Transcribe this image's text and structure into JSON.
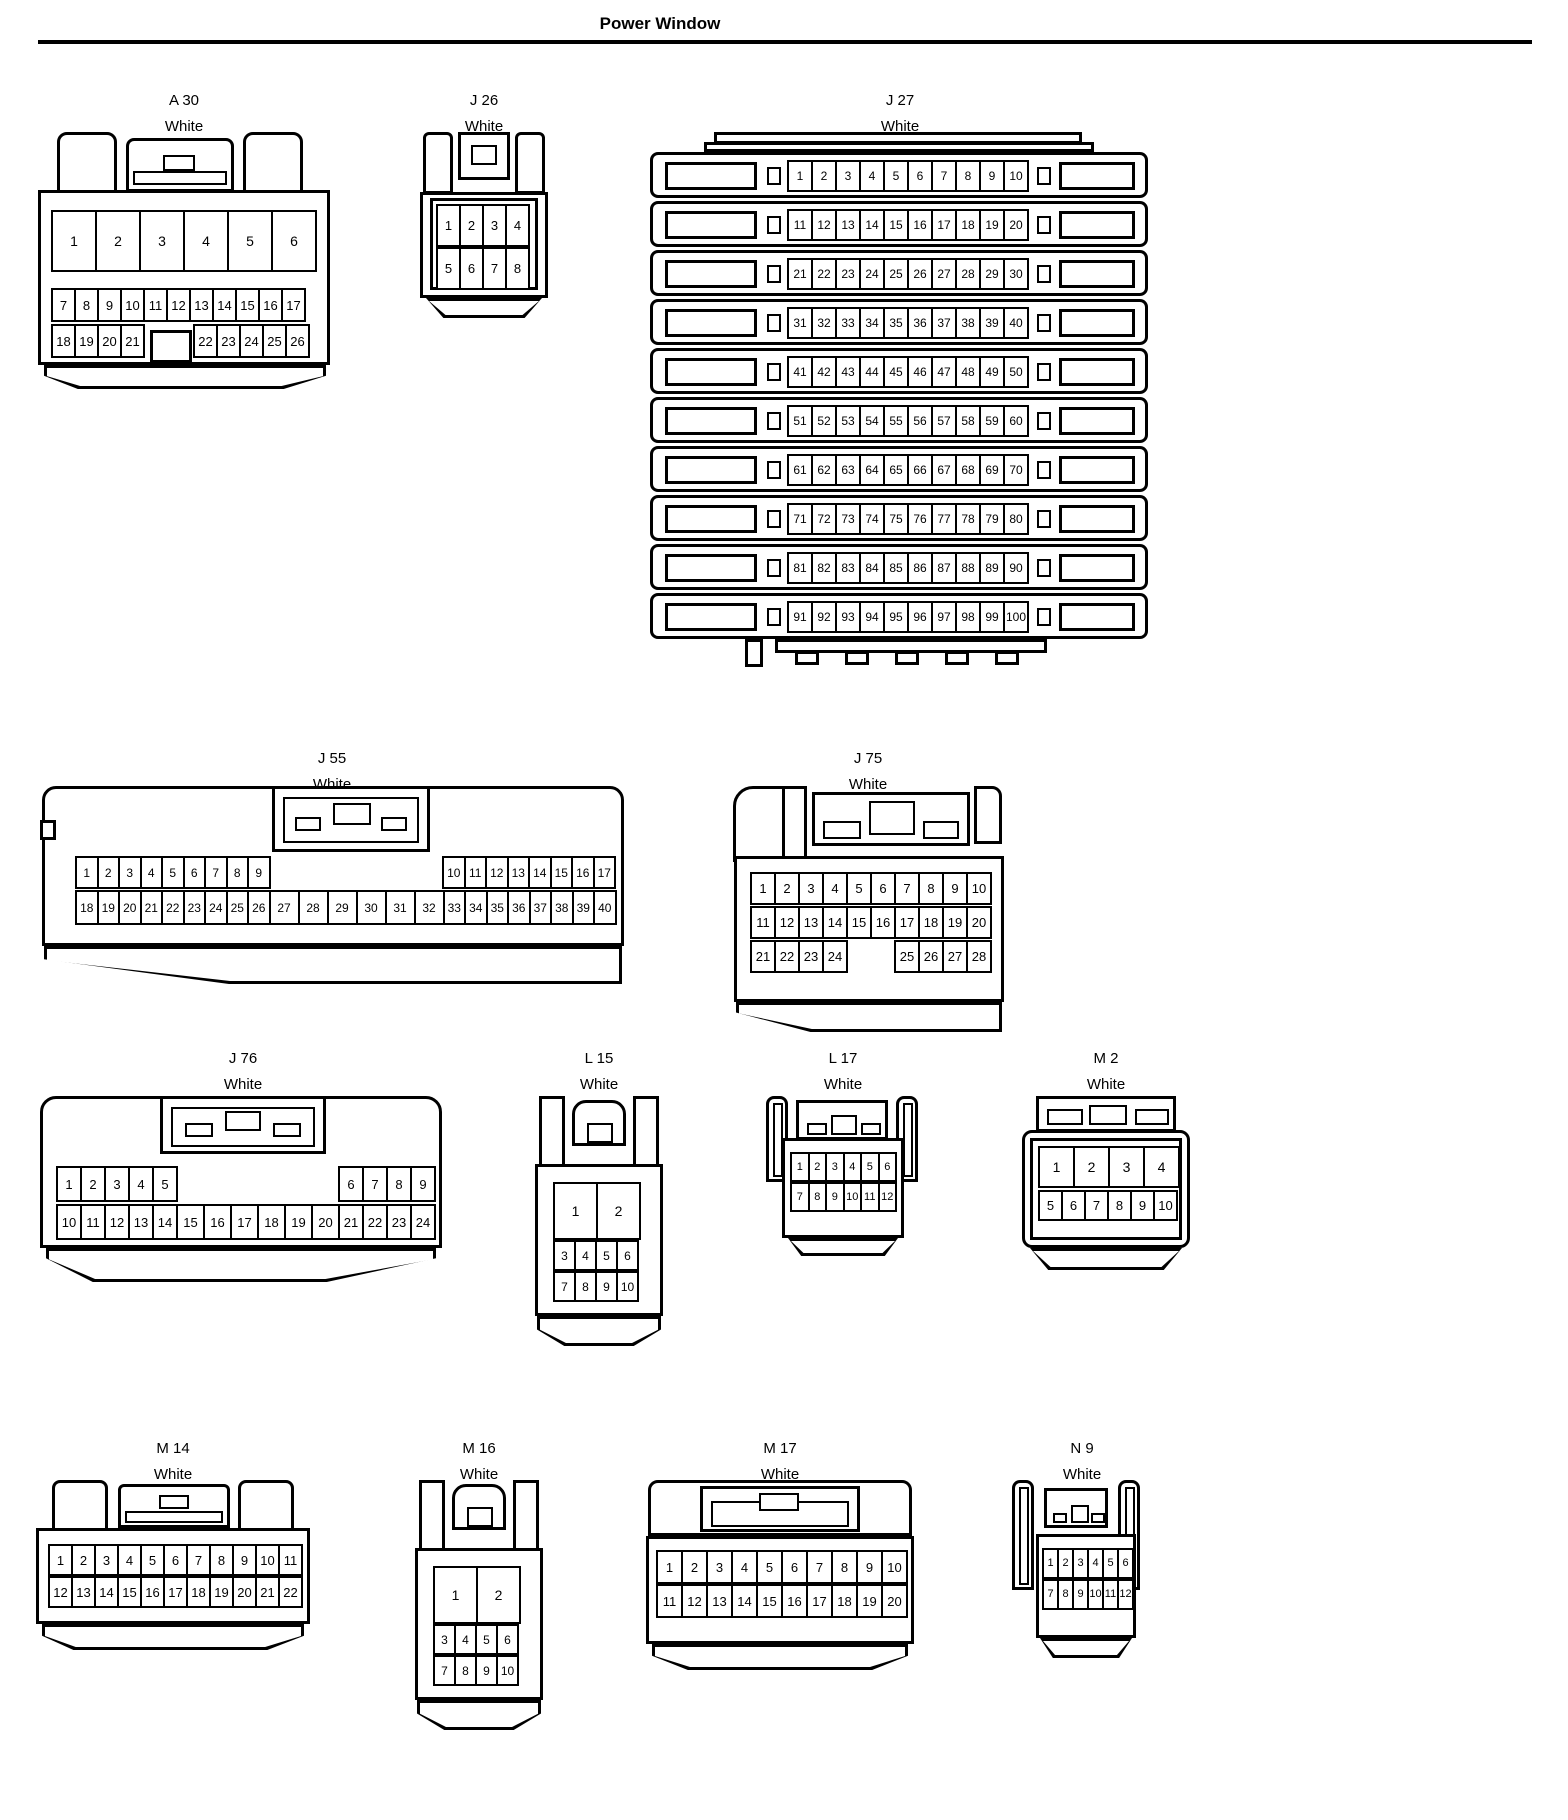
{
  "page": {
    "title": "Power Window"
  },
  "colors": {
    "outline": "#000000",
    "background": "#ffffff",
    "text": "#000000"
  },
  "connectors": [
    {
      "id": "a30",
      "name": "A 30",
      "color": "White",
      "pins": {
        "r1": [
          "1",
          "2",
          "3",
          "4",
          "5",
          "6"
        ],
        "r2": [
          "7",
          "8",
          "9",
          "10",
          "11",
          "12",
          "13",
          "14",
          "15",
          "16",
          "17"
        ],
        "r3": [
          "18",
          "19",
          "20",
          "21",
          {
            "sp": 48
          },
          "22",
          "23",
          "24",
          "25",
          "26"
        ]
      }
    },
    {
      "id": "j26",
      "name": "J 26",
      "color": "White",
      "pins": {
        "r1": [
          "1",
          "2",
          "3",
          "4"
        ],
        "r2": [
          "5",
          "6",
          "7",
          "8"
        ]
      }
    },
    {
      "id": "j27",
      "name": "J 27",
      "color": "White",
      "pins": {
        "rows": [
          [
            "1",
            "2",
            "3",
            "4",
            "5",
            "6",
            "7",
            "8",
            "9",
            "10"
          ],
          [
            "11",
            "12",
            "13",
            "14",
            "15",
            "16",
            "17",
            "18",
            "19",
            "20"
          ],
          [
            "21",
            "22",
            "23",
            "24",
            "25",
            "26",
            "27",
            "28",
            "29",
            "30"
          ],
          [
            "31",
            "32",
            "33",
            "34",
            "35",
            "36",
            "37",
            "38",
            "39",
            "40"
          ],
          [
            "41",
            "42",
            "43",
            "44",
            "45",
            "46",
            "47",
            "48",
            "49",
            "50"
          ],
          [
            "51",
            "52",
            "53",
            "54",
            "55",
            "56",
            "57",
            "58",
            "59",
            "60"
          ],
          [
            "61",
            "62",
            "63",
            "64",
            "65",
            "66",
            "67",
            "68",
            "69",
            "70"
          ],
          [
            "71",
            "72",
            "73",
            "74",
            "75",
            "76",
            "77",
            "78",
            "79",
            "80"
          ],
          [
            "81",
            "82",
            "83",
            "84",
            "85",
            "86",
            "87",
            "88",
            "89",
            "90"
          ],
          [
            "91",
            "92",
            "93",
            "94",
            "95",
            "96",
            "97",
            "98",
            "99",
            "100"
          ]
        ]
      }
    },
    {
      "id": "j55",
      "name": "J 55",
      "color": "White",
      "pins": {
        "r1a": [
          "1",
          "2",
          "3",
          "4",
          "5",
          "6",
          "7",
          "8",
          "9"
        ],
        "r1b": [
          "10",
          "11",
          "12",
          "13",
          "14",
          "15",
          "16",
          "17"
        ],
        "r2": [
          "18",
          "19",
          "20",
          "21",
          "22",
          "23",
          "24",
          "25",
          "26",
          {
            "t": "27",
            "w": 31
          },
          {
            "t": "28",
            "w": 31
          },
          {
            "t": "29",
            "w": 31
          },
          {
            "t": "30",
            "w": 31
          },
          {
            "t": "31",
            "w": 31
          },
          {
            "t": "32",
            "w": 31
          },
          "33",
          "34",
          "35",
          "36",
          "37",
          "38",
          "39",
          "40"
        ]
      }
    },
    {
      "id": "j75",
      "name": "J 75",
      "color": "White",
      "pins": {
        "r1": [
          "1",
          "2",
          "3",
          "4",
          "5",
          "6",
          "7",
          "8",
          "9",
          "10"
        ],
        "r2": [
          "11",
          "12",
          "13",
          "14",
          "15",
          "16",
          "17",
          "18",
          "19",
          "20"
        ],
        "r3": [
          "21",
          "22",
          "23",
          "24",
          {
            "sp": 46
          },
          "25",
          "26",
          "27",
          "28"
        ]
      }
    },
    {
      "id": "j76",
      "name": "J 76",
      "color": "White",
      "pins": {
        "r1a": [
          "1",
          "2",
          "3",
          "4",
          "5"
        ],
        "r1b": [
          "6",
          "7",
          "8",
          "9"
        ],
        "r2": [
          "10",
          "11",
          "12",
          "13",
          "14",
          {
            "t": "15",
            "w": 29
          },
          {
            "t": "16",
            "w": 29
          },
          {
            "t": "17",
            "w": 29
          },
          {
            "t": "18",
            "w": 29
          },
          {
            "t": "19",
            "w": 29
          },
          {
            "t": "20",
            "w": 29
          },
          "21",
          "22",
          "23",
          "24"
        ]
      }
    },
    {
      "id": "l15",
      "name": "L 15",
      "color": "White",
      "pins": {
        "r1": [
          "1",
          "2"
        ],
        "r2": [
          "3",
          "4",
          "5",
          "6"
        ],
        "r3": [
          "7",
          "8",
          "9",
          "10"
        ]
      }
    },
    {
      "id": "l17",
      "name": "L 17",
      "color": "White",
      "pins": {
        "r1": [
          "1",
          "2",
          "3",
          "4",
          "5",
          "6"
        ],
        "r2": [
          "7",
          "8",
          "9",
          "10",
          "11",
          "12"
        ]
      }
    },
    {
      "id": "m2",
      "name": "M 2",
      "color": "White",
      "pins": {
        "r1": [
          "1",
          "2",
          "3",
          "4"
        ],
        "r2": [
          "5",
          "6",
          "7",
          "8",
          "9",
          "10"
        ]
      }
    },
    {
      "id": "m14",
      "name": "M 14",
      "color": "White",
      "pins": {
        "r1": [
          "1",
          "2",
          "3",
          "4",
          "5",
          "6",
          "7",
          "8",
          "9",
          "10",
          "11"
        ],
        "r2": [
          "12",
          "13",
          "14",
          "15",
          "16",
          "17",
          "18",
          "19",
          "20",
          "21",
          "22"
        ]
      }
    },
    {
      "id": "m16",
      "name": "M 16",
      "color": "White",
      "pins": {
        "r1": [
          "1",
          "2"
        ],
        "r2": [
          "3",
          "4",
          "5",
          "6"
        ],
        "r3": [
          "7",
          "8",
          "9",
          "10"
        ]
      }
    },
    {
      "id": "m17",
      "name": "M 17",
      "color": "White",
      "pins": {
        "r1": [
          "1",
          "2",
          "3",
          "4",
          "5",
          "6",
          "7",
          "8",
          "9",
          "10"
        ],
        "r2": [
          "11",
          "12",
          "13",
          "14",
          "15",
          "16",
          "17",
          "18",
          "19",
          "20"
        ]
      }
    },
    {
      "id": "n9",
      "name": "N 9",
      "color": "White",
      "pins": {
        "r1": [
          "1",
          "2",
          "3",
          "4",
          "5",
          "6"
        ],
        "r2": [
          "7",
          "8",
          "9",
          "10",
          "11",
          "12"
        ]
      }
    }
  ]
}
